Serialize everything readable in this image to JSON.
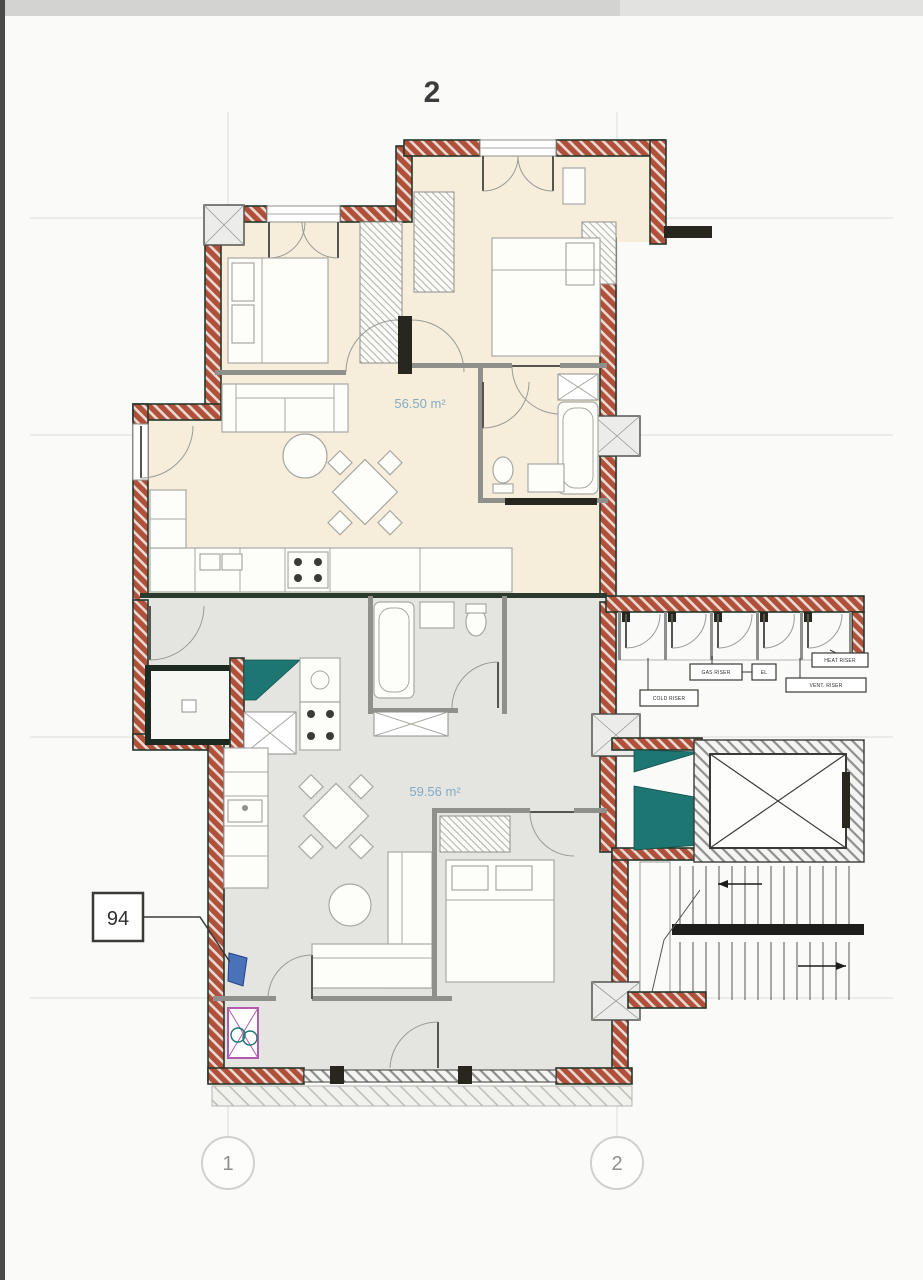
{
  "page": {
    "top_axis_label": "2",
    "bubble_1": "1",
    "bubble_2": "2"
  },
  "apartments": {
    "upper": {
      "area_label": "56.50 m²"
    },
    "lower": {
      "area_label": "59.56 m²",
      "unit_number": "94"
    }
  },
  "utility": {
    "c1": "COLD RISER",
    "c2": "GAS RISER",
    "c3": "EL",
    "c4": "HEAT RISER",
    "c5": "VENT. RISER"
  },
  "colors": {
    "brick": "#b0503a",
    "wall_edge": "#27382c",
    "upper_floor": "#f6eedb",
    "lower_floor": "#e4e5e1",
    "teal_duct": "#1d7672",
    "area_text": "#85aac3",
    "marker_blue": "#4a72b8",
    "marker_purple": "#b05ab0"
  }
}
